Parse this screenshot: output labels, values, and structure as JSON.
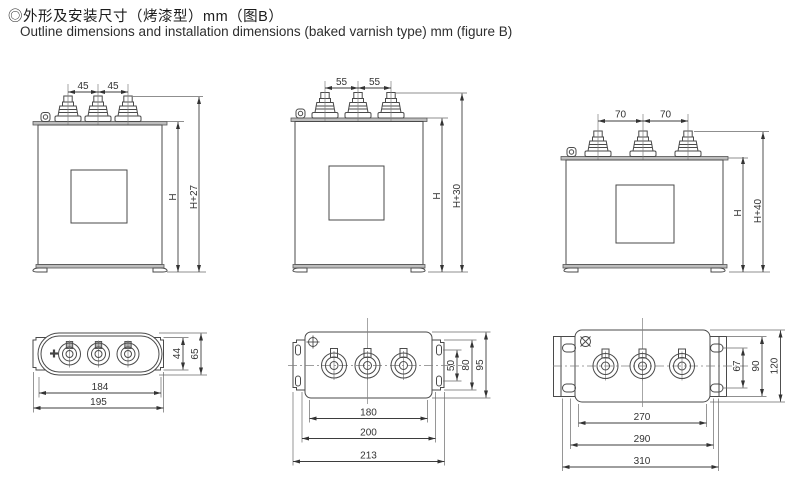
{
  "header": {
    "title_zh": "◎外形及安装尺寸（烤漆型）mm（图B）",
    "title_en": "Outline dimensions and installation dimensions (baked varnish type) mm (figure B)"
  },
  "front_views": [
    {
      "spacing_left": "45",
      "spacing_right": "45",
      "body_height": "H",
      "overall_height": "H+27"
    },
    {
      "spacing_left": "55",
      "spacing_right": "55",
      "body_height": "H",
      "overall_height": "H+30"
    },
    {
      "spacing_left": "70",
      "spacing_right": "70",
      "body_height": "H",
      "overall_height": "H+40"
    }
  ],
  "top_views": [
    {
      "plate_width": "44",
      "body_width": "65",
      "body_length": "184",
      "overall_length": "195"
    },
    {
      "hole_spacing": "50",
      "plate_width": "80",
      "body_width": "95",
      "hole_length": "180",
      "body_length": "200",
      "overall_length": "213"
    },
    {
      "hole_spacing": "67",
      "plate_width": "90",
      "body_width": "120",
      "hole_length": "270",
      "body_length": "290",
      "overall_length": "310"
    }
  ],
  "drawing_colors": {
    "line": "#4a4a4a",
    "lid_fill": "#bdbdbd",
    "background": "#ffffff"
  }
}
